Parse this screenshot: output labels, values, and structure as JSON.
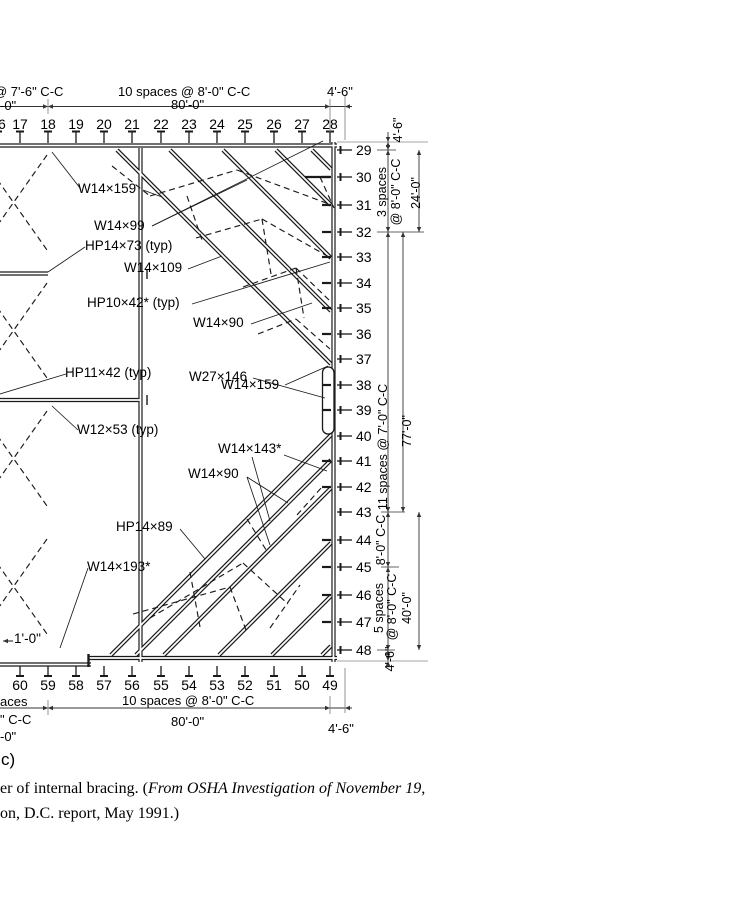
{
  "figure": {
    "part_label": "c)",
    "caption_roman": "er of internal bracing. (",
    "caption_italic_1": "From OSHA Investigation of November 19,",
    "caption_italic_2": "on, D.C. report, May 1991.)"
  },
  "grids": {
    "top": [
      "16",
      "17",
      "18",
      "19",
      "20",
      "21",
      "22",
      "23",
      "24",
      "25",
      "26",
      "27",
      "28"
    ],
    "right": [
      "29",
      "30",
      "31",
      "32",
      "33",
      "34",
      "35",
      "36",
      "37",
      "38",
      "39",
      "40",
      "41",
      "42",
      "43",
      "44",
      "45",
      "46",
      "47",
      "48"
    ],
    "bottom": [
      "60",
      "59",
      "58",
      "57",
      "56",
      "55",
      "54",
      "53",
      "52",
      "51",
      "50",
      "49"
    ]
  },
  "dimensions": {
    "top_left_spacing": "@ 7'-6\" C-C",
    "top_left_total": "-0\"",
    "top_spacing": "10 spaces @ 8'-0\" C-C",
    "top_total": "80'-0\"",
    "top_right": "4'-6\"",
    "bottom_left_spacing": "aces",
    "bottom_left_cc": "\" C-C",
    "bottom_left_total": "-0\"",
    "bottom_spacing": "10 spaces @ 8'-0\" C-C",
    "bottom_total": "80'-0\"",
    "bottom_right": "4'-6\"",
    "right": {
      "r1": "4'-6\"",
      "r2": "3 spaces",
      "r3": "@ 8'-0\" C-C",
      "r4": "24'-0\"",
      "r5": "11 spaces @ 7'-0\" C-C",
      "r6": "77'-0\"",
      "r7": "8'-0\" C-C",
      "r8": "5 spaces",
      "r9": "@ 8'-0\" C-C",
      "r10": "40'-0\"",
      "r11": "4'-6\""
    }
  },
  "member_labels": {
    "w14x159_top": "W14×159",
    "w14x99": "W14×99",
    "hp14x73": "HP14×73 (typ)",
    "w14x109": "W14×109",
    "hp10x42": "HP10×42* (typ)",
    "w14x90_top": "W14×90",
    "w14x159_mid": "W14×159",
    "w27x146": "W27×146",
    "hp11x42": "HP11×42 (typ)",
    "w12x53": "W12×53 (typ)",
    "w14x143": "W14×143*",
    "w14x90_bot": "W14×90",
    "hp14x89": "HP14×89",
    "w14x193": "W14×193*",
    "offset": "1'-0\""
  },
  "colors": {
    "line": "#1a1a1a",
    "dim_line": "#333333",
    "extension": "#888888",
    "background": "#ffffff"
  }
}
